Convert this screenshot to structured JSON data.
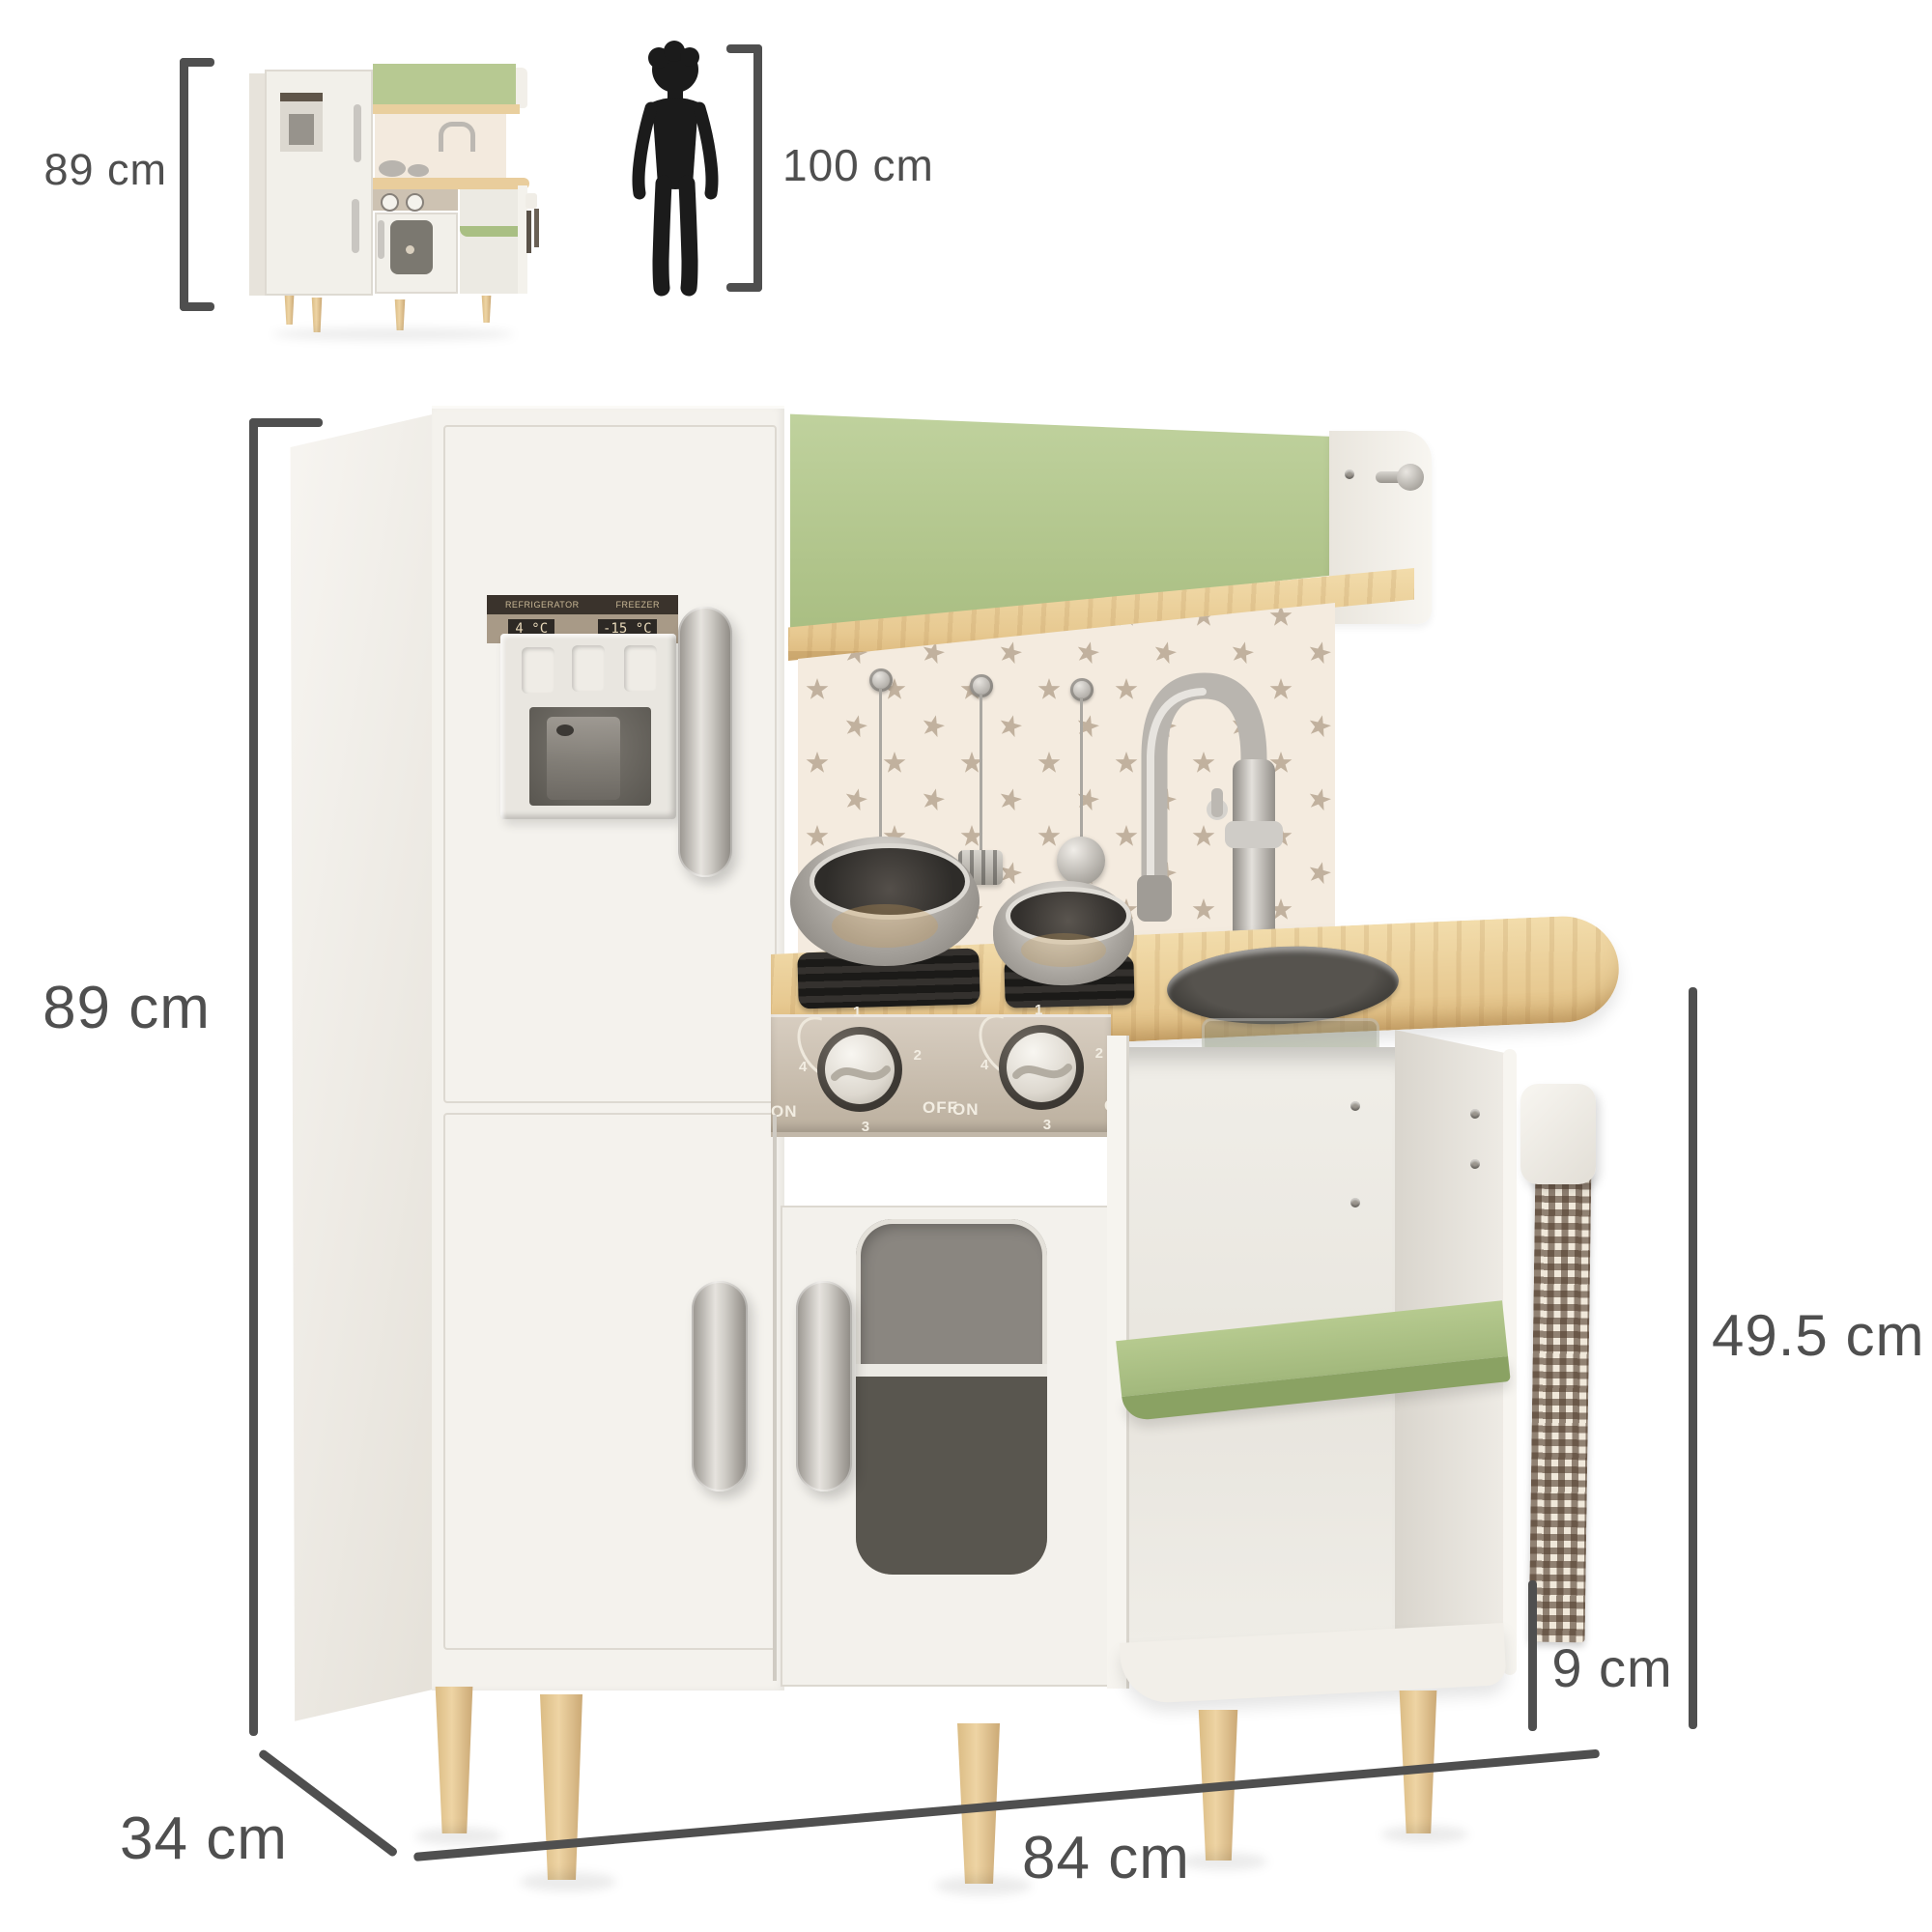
{
  "scale_reference": {
    "thumbnail_label": "89 cm",
    "child_label": "100 cm"
  },
  "dimension_labels": {
    "height": "89 cm",
    "width": "84 cm",
    "depth": "34 cm",
    "counter_height": "49.5 cm",
    "leg_height": "9 cm"
  },
  "kitchen": {
    "fridge_panel": {
      "refrigerator_label": "REFRIGERATOR",
      "freezer_label": "FREEZER",
      "refrigerator_temp": "4 °C",
      "freezer_temp": "-15 °C"
    },
    "stove": {
      "on_label": "ON",
      "off_label": "OFF",
      "dial_numbers": [
        "1",
        "2",
        "3",
        "4"
      ]
    },
    "colors": {
      "accent_green": "#b5c791",
      "shelf_green": "#a3b97d",
      "wood": "#e9cd9e",
      "leg_wood": "#ddbe8a",
      "star_wall_bg": "#f4ebdf",
      "star": "#c1b19e",
      "cabinet_white": "#f4f2ed",
      "panel_beige": "#c9bcab",
      "silver": "#c6c3be",
      "dimension_gray": "#4f4f4f"
    }
  }
}
